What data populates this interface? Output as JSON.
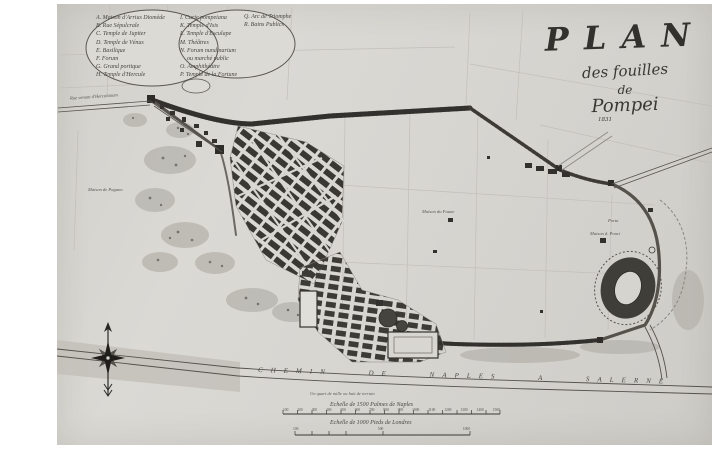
{
  "title": {
    "plan": "PLAN",
    "line2": "des fouilles",
    "line3": "de",
    "line4": "Pompei",
    "year": "1831"
  },
  "legend": {
    "col1": [
      "A. Maison d'Arrius Diomède",
      "B. Rue Sépulcrale",
      "C. Temple de Jupiter",
      "D. Temple de Vénus",
      "E. Basilique",
      "F. Forum",
      "G. Grand portique",
      "H. Temple d'Hercule"
    ],
    "col2": [
      "I. Curie pompeiana",
      "K. Temple d'Isis",
      "L. Temple d'Esculape",
      "M. Théâtres",
      "N. Forum nundinarium",
      "ou marché public",
      "O. Amphithéâtre",
      "P. Temple de la Fortune"
    ],
    "col3": [
      "Q. Arc de Triomphe",
      "R. Bains Publics"
    ]
  },
  "road_label": "CHEMIN DE NAPLES A SALERNE",
  "map_labels": {
    "road_nw": "Rue venant d'Herculanum",
    "house_w": "Maison de Pagano",
    "house_c": "Maison du Faune",
    "porta_e": "Porta",
    "house_e": "Maison d. Ponci"
  },
  "scale": {
    "note": "Un quart de mille ou huit de terrain",
    "bar1_label": "Echelle de 1500 Palmes de Naples",
    "bar1_ticks": [
      "100",
      "200",
      "300",
      "400",
      "500",
      "600",
      "700",
      "800",
      "900",
      "1000",
      "1100",
      "1200",
      "1300",
      "1400",
      "1500"
    ],
    "bar2_label": "Echelle de 1000 Pieds de Londres",
    "bar2_ticks": [
      "100",
      "500",
      "1000"
    ]
  },
  "colors": {
    "paper": "#d7d5d0",
    "ink": "#2f2d29",
    "wall": "#44423d",
    "faint": "#c2bfb8"
  }
}
